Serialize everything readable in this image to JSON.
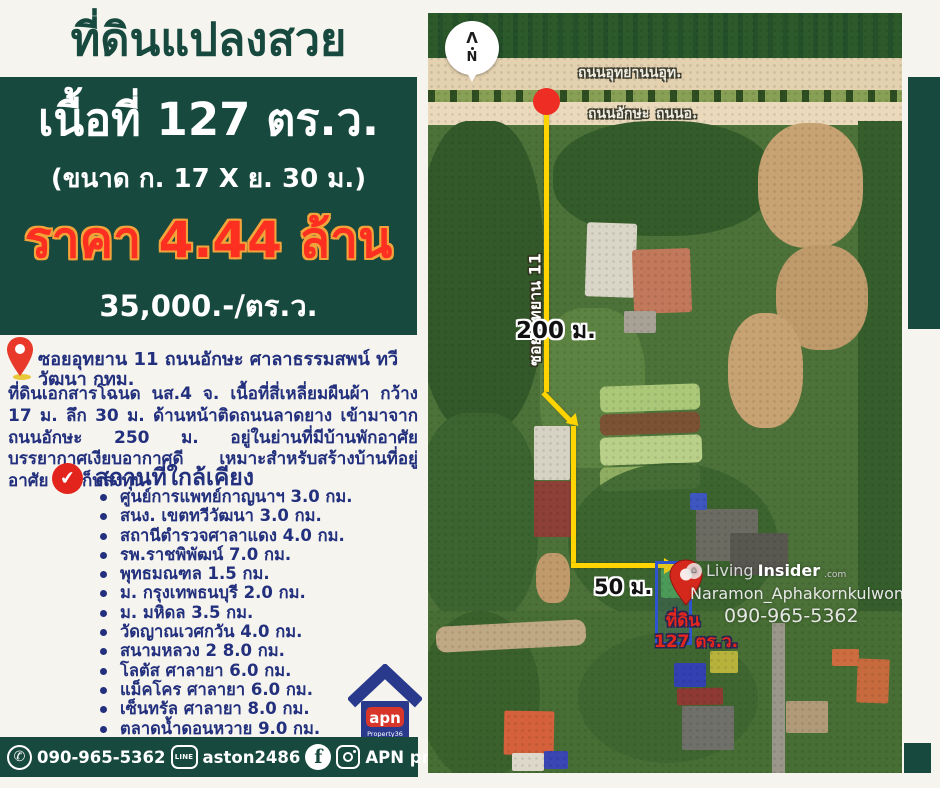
{
  "page": {
    "bg_color": "#f5f4ee",
    "accent_green": "#17493e",
    "navy_text": "#23307d",
    "price_red": "#fc2f21",
    "price_outline": "#f2a43b",
    "route_yellow": "#ffd400"
  },
  "header": {
    "title": "ที่ดินแปลงสวย"
  },
  "price_box": {
    "area": "เนื้อที่ 127 ตร.ว.",
    "size": "(ขนาด ก. 17 X ย. 30 ม.)",
    "price": "ราคา 4.44 ล้าน",
    "unit_price": "35,000.-/ตร.ว."
  },
  "location": {
    "address": "ซอยอุทยาน 11 ถนนอักษะ ศาลาธรรมสพน์ ทวีวัฒนา กทม."
  },
  "description": "ที่ดินเอกสารโฉนด นส.4 จ. เนื้อที่สี่เหลี่ยมผืนผ้า กว้าง 17 ม. ลึก 30 ม. ด้านหน้าติดถนนลาดยาง เข้ามาจากถนนอักษะ 250 ม. อยู่ในย่านที่มีบ้านพักอาศัย บรรยากาศเงียบอากาศดี เหมาะสำหรับสร้างบ้านที่อยู่อาศัย ซื้อเก็บลงทุน",
  "nearby": {
    "heading": "สถานที่ใกล้เคียง",
    "items": [
      "ศูนย์การแพทย์กาญนาฯ 3.0 กม.",
      "สนง. เขตทวีวัฒนา 3.0 กม.",
      "สถานีตำรวจศาลาแดง 4.0 กม.",
      "รพ.ราชพิพัฒน์ 7.0 กม.",
      "พุทธมณฑล 1.5 กม.",
      "ม. กรุงเทพธนบุรี 2.0 กม.",
      "ม. มหิดล 3.5 กม.",
      "วัดญาณเวศกวัน 4.0 กม.",
      "สนามหลวง 2  8.0 กม.",
      "โลตัส ศาลายา 6.0 กม.",
      "แม็คโคร ศาลายา 6.0 กม.",
      "เซ็นทรัล ศาลายา 8.0 กม.",
      "ตลาดน้ำดอนหวาย 9.0 กม."
    ]
  },
  "logo": {
    "name": "apn",
    "subtitle": "Property36"
  },
  "contact": {
    "phone": "090-965-5362",
    "line_label": "LINE",
    "line_id": "aston2486",
    "facebook_letter": "f",
    "social_name": "APN property36"
  },
  "map": {
    "compass_arrow": "Λ",
    "compass_letter": "N",
    "road_top": "ถนนอุทยานนอุท.",
    "road_mid_a": "ถนนอักษะ",
    "road_mid_b": "ถนนอ.",
    "soi_label": "ซอย อุทยาน 11",
    "dist_main": "200 ม.",
    "dist_side": "50 ม.",
    "plot_tag": "ที่ดิน",
    "plot_area": "127 ตร.ว.",
    "watermark_icon": "⌂",
    "watermark_light": "Living",
    "watermark_bold": "Insider",
    "watermark_tld": ".com",
    "watermark_user": "Naramon_Aphakornkulwong",
    "watermark_phone": "090-965-5362",
    "check_mark": "✔",
    "phone_glyph": "✆"
  }
}
